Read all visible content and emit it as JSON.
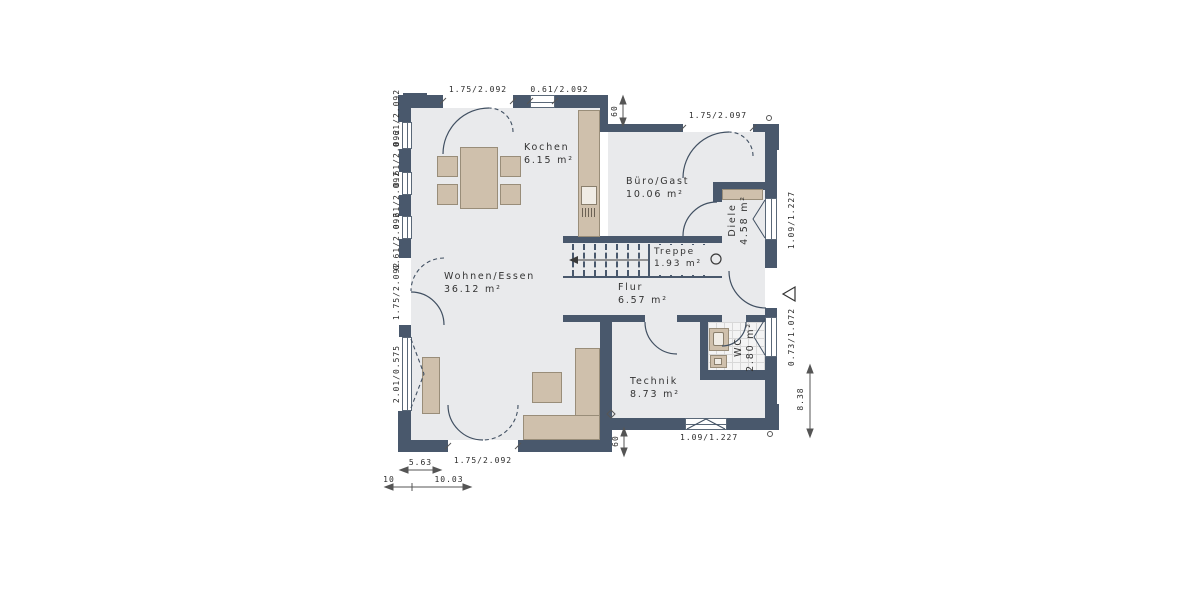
{
  "rooms": {
    "kochen": {
      "name": "Kochen",
      "area": "6.15 m²"
    },
    "buero": {
      "name": "Büro/Gast",
      "area": "10.06 m²"
    },
    "diele": {
      "name": "Diele",
      "area": "4.58 m²"
    },
    "treppe": {
      "name": "Treppe",
      "area": "1.93 m²"
    },
    "wohnen": {
      "name": "Wohnen/Essen",
      "area": "36.12 m²"
    },
    "flur": {
      "name": "Flur",
      "area": "6.57 m²"
    },
    "wc": {
      "name": "WC",
      "area": "2.80 m²"
    },
    "technik": {
      "name": "Technik",
      "area": "8.73 m²"
    }
  },
  "dims": {
    "top_door": "1.75/2.092",
    "top_window": "0.61/2.092",
    "buero_door": "1.75/2.097",
    "left_windows": [
      "0.61/2.092",
      "0.61/2.092",
      "0.61/2.092",
      "0.61/2.092"
    ],
    "left_door": "1.75/2.092",
    "left_big_window": "2.01/0.575",
    "bottom_door": "1.75/2.092",
    "diele_window": "1.09/1.227",
    "wc_window": "0.73/1.072",
    "technik_window": "1.09/1.227",
    "step_top": "60",
    "step_bottom": "60",
    "width_partial": "5.63",
    "width_left": "10",
    "width_total": "10.03",
    "height_total": "8.38"
  },
  "colors": {
    "wall": "#49586c",
    "floor": "#e9eaec",
    "furniture": "#cfc0ac",
    "background": "#ffffff"
  }
}
